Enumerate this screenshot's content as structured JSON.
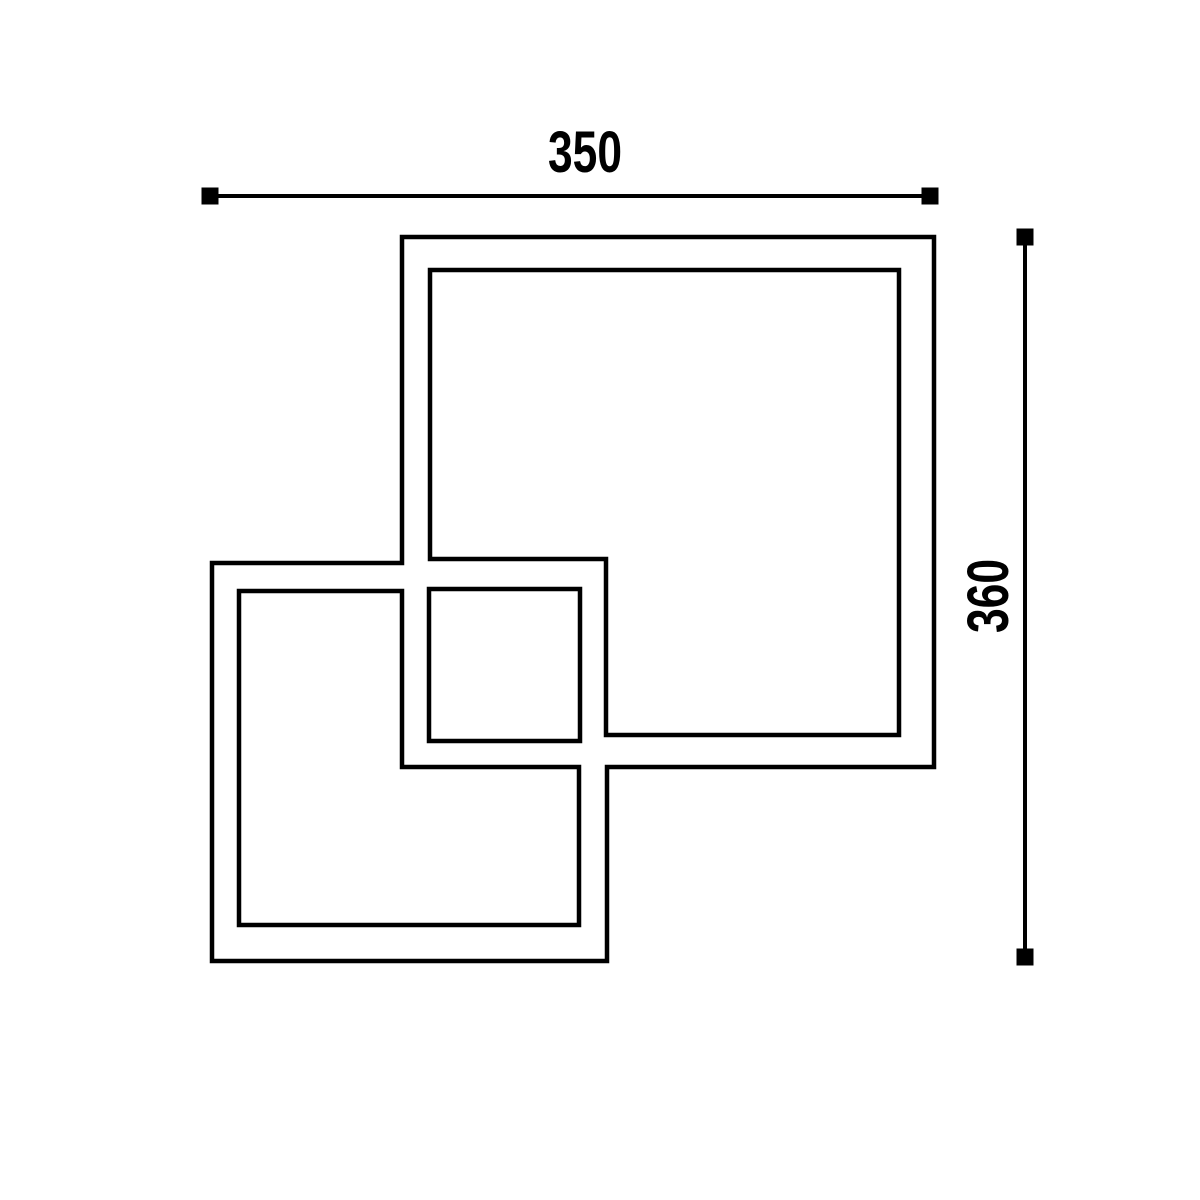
{
  "drawing": {
    "description": "Plan-view line drawing of two overlapping square frames with overall dimensions",
    "colors": {
      "line": "#000000",
      "background": "#ffffff",
      "text": "#000000"
    },
    "dimensions": {
      "width_label": "350",
      "height_label": "360"
    }
  }
}
